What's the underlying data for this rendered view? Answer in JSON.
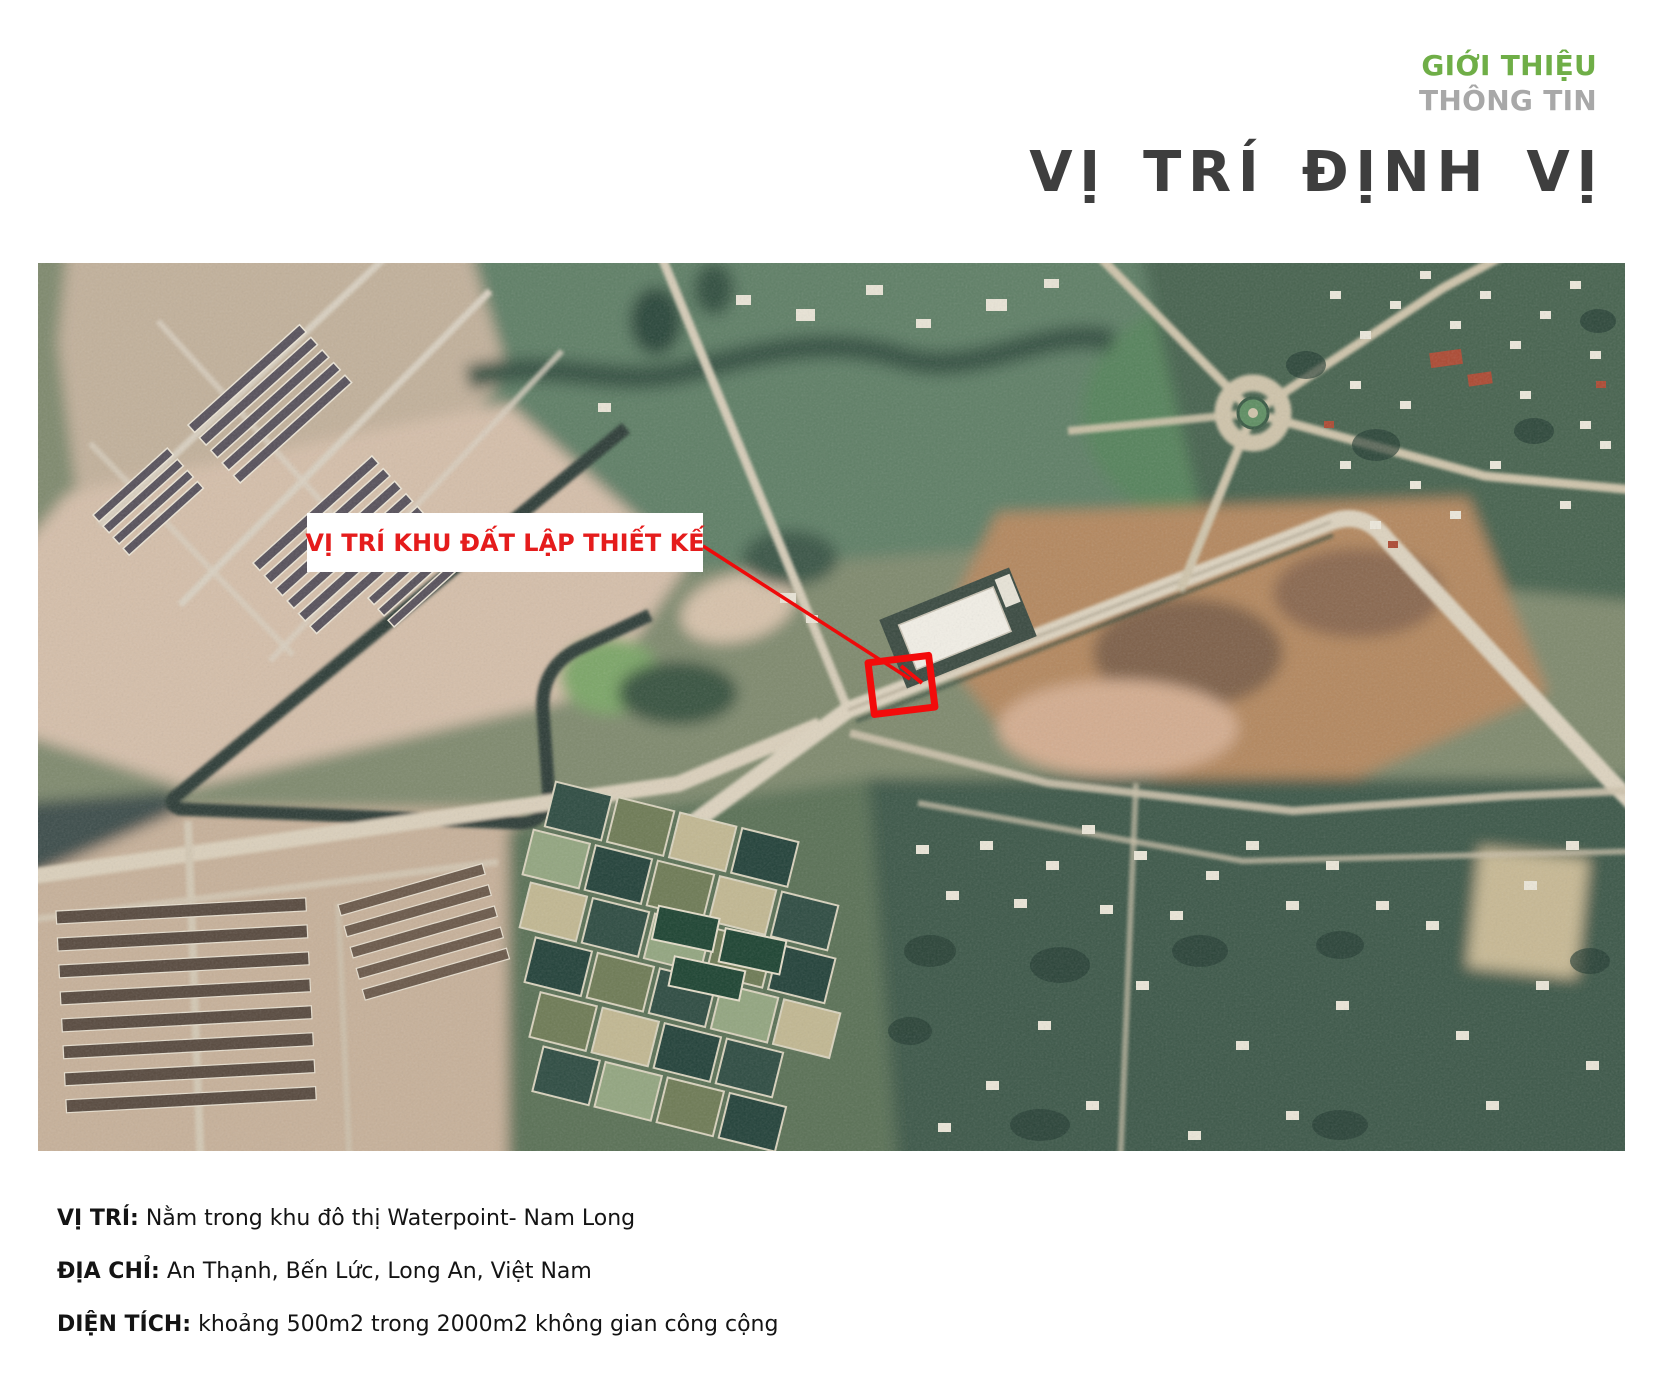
{
  "header": {
    "kicker_primary": "GIỚI THIỆU",
    "kicker_secondary": "THÔNG TIN",
    "title": "VỊ TRÍ ĐỊNH VỊ"
  },
  "map": {
    "callout_label": "VỊ TRÍ KHU ĐẤT LẬP THIẾT KẾ",
    "type": "satellite-aerial-photo",
    "marked_site": "red outlined plot at central road intersection"
  },
  "info": {
    "rows": [
      {
        "label": "VỊ TRÍ:",
        "text": "Nằm trong khu đô thị Waterpoint- Nam Long"
      },
      {
        "label": "ĐỊA CHỈ:",
        "text": "An Thạnh, Bến Lức, Long An, Việt Nam"
      },
      {
        "label": "DIỆN TÍCH:",
        "text": "khoảng 500m2 trong 2000m2 không gian công cộng"
      }
    ]
  },
  "colors": {
    "accent_green": "#6FAE47",
    "muted_gray": "#A8A8A8",
    "title_gray": "#3E3E3E",
    "callout_red": "#E51C1C",
    "site_outline_red": "#F30B0B"
  }
}
